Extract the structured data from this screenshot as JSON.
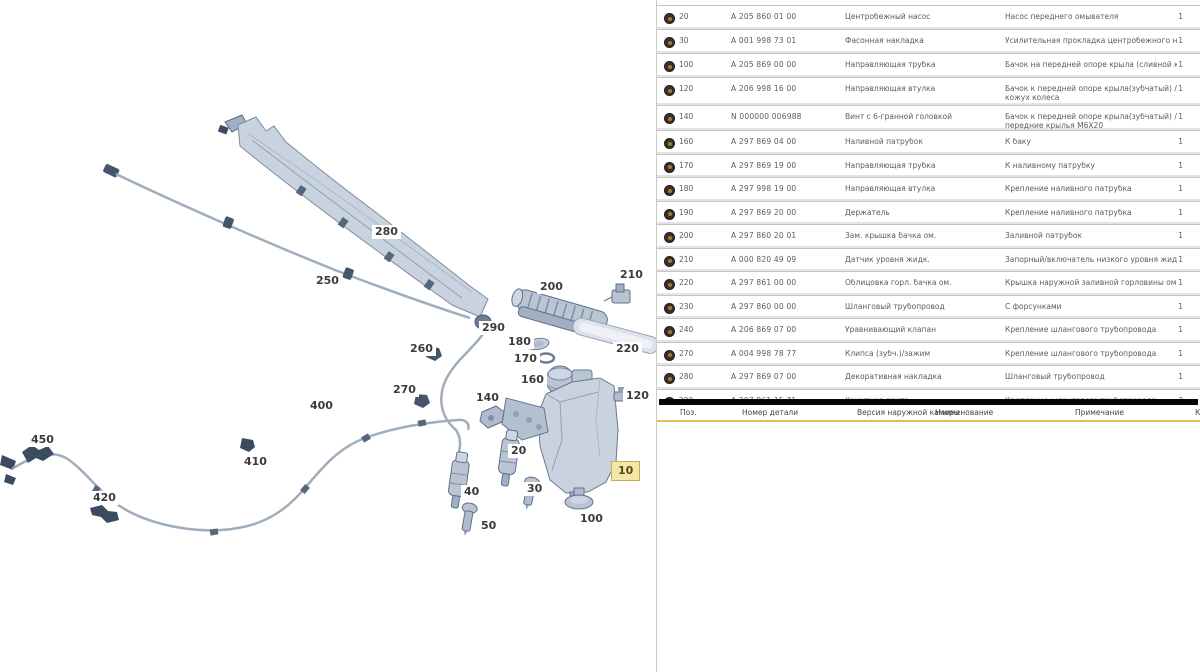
{
  "app": {
    "description": "parts-catalog-washer-system",
    "colors": {
      "highlight_bg": "#f3e7ab",
      "highlight_border": "#c9ac4e",
      "accent_line": "#ddc050",
      "split_bar": "#060606",
      "part_fill": "#c9d3df",
      "part_stroke": "#6e7f95"
    }
  },
  "diagram": {
    "callouts": [
      {
        "n": "280",
        "x": 372,
        "y": 225,
        "highlight": false
      },
      {
        "n": "250",
        "x": 313,
        "y": 274,
        "highlight": false
      },
      {
        "n": "290",
        "x": 479,
        "y": 321,
        "highlight": false
      },
      {
        "n": "260",
        "x": 407,
        "y": 342,
        "highlight": false
      },
      {
        "n": "270",
        "x": 390,
        "y": 383,
        "highlight": false
      },
      {
        "n": "400",
        "x": 307,
        "y": 399,
        "highlight": false
      },
      {
        "n": "450",
        "x": 28,
        "y": 433,
        "highlight": false
      },
      {
        "n": "410",
        "x": 241,
        "y": 455,
        "highlight": false
      },
      {
        "n": "420",
        "x": 90,
        "y": 491,
        "highlight": false
      },
      {
        "n": "200",
        "x": 537,
        "y": 280,
        "highlight": false
      },
      {
        "n": "210",
        "x": 617,
        "y": 268,
        "highlight": false
      },
      {
        "n": "220",
        "x": 613,
        "y": 342,
        "highlight": false
      },
      {
        "n": "180",
        "x": 505,
        "y": 335,
        "highlight": false
      },
      {
        "n": "170",
        "x": 511,
        "y": 352,
        "highlight": false
      },
      {
        "n": "160",
        "x": 518,
        "y": 373,
        "highlight": false
      },
      {
        "n": "140",
        "x": 473,
        "y": 391,
        "highlight": false
      },
      {
        "n": "120",
        "x": 623,
        "y": 389,
        "highlight": false
      },
      {
        "n": "20",
        "x": 508,
        "y": 444,
        "highlight": false
      },
      {
        "n": "30",
        "x": 524,
        "y": 482,
        "highlight": false
      },
      {
        "n": "40",
        "x": 461,
        "y": 485,
        "highlight": false
      },
      {
        "n": "50",
        "x": 478,
        "y": 519,
        "highlight": false
      },
      {
        "n": "100",
        "x": 577,
        "y": 512,
        "highlight": false
      },
      {
        "n": "10",
        "x": 611,
        "y": 461,
        "highlight": true
      }
    ]
  },
  "parts_table": {
    "rows": [
      {
        "pos": "20",
        "num": "A 205 860 01 00",
        "name": "Центробежный насос",
        "remark": "Насос переднего омывателя",
        "qty": "1",
        "wrap": false
      },
      {
        "pos": "30",
        "num": "A 001 998 73 01",
        "name": "Фасонная накладка",
        "remark": "Усилительная прокладка центробежного насоса",
        "qty": "1",
        "wrap": false
      },
      {
        "pos": "100",
        "num": "A 205 869 00 00",
        "name": "Направляющая трубка",
        "remark": "Бачок на передней опоре крыла (сливной кран)",
        "qty": "1",
        "wrap": false
      },
      {
        "pos": "120",
        "num": "A 206 998 16 00",
        "name": "Направляющая втулка",
        "remark": "Бачок к передней опоре крыла(зубчатый) / кожух колеса",
        "qty": "1",
        "wrap": true
      },
      {
        "pos": "140",
        "num": "N 000000 006988",
        "name": "Винт с 6-гранной головкой",
        "remark": "Бачок к передней опоре крыла(зубчатый) / передние крылья M6X20",
        "qty": "1",
        "wrap": true
      },
      {
        "pos": "160",
        "num": "A 297 869 04 00",
        "name": "Наливной патрубок",
        "remark": "К баку",
        "qty": "1",
        "wrap": false
      },
      {
        "pos": "170",
        "num": "A 297 869 19 00",
        "name": "Направляющая трубка",
        "remark": "К наливному патрубку",
        "qty": "1",
        "wrap": false
      },
      {
        "pos": "180",
        "num": "A 297 998 19 00",
        "name": "Направляющая втулка",
        "remark": "Крепление наливного патрубка",
        "qty": "1",
        "wrap": false
      },
      {
        "pos": "190",
        "num": "A 297 869 20 00",
        "name": "Держатель",
        "remark": "Крепление наливного патрубка",
        "qty": "1",
        "wrap": false
      },
      {
        "pos": "200",
        "num": "A 297 860 20 01",
        "name": "Зам. крышка бачка ом.",
        "remark": "Заливной патрубок",
        "qty": "1",
        "wrap": false
      },
      {
        "pos": "210",
        "num": "A 000 820 49 09",
        "name": "Датчик уровня жидк.",
        "remark": "Запорный/включатель низкого уровня жидкости",
        "qty": "1",
        "wrap": false
      },
      {
        "pos": "220",
        "num": "A 297 861 00 00",
        "name": "Облицовка горл. бачка ом.",
        "remark": "Крышка наружной заливной горловины омывающей жидкости",
        "qty": "1",
        "wrap": false
      },
      {
        "pos": "230",
        "num": "A 297 860 00 00",
        "name": "Шланговый трубопровод",
        "remark": "С форсунками",
        "qty": "1",
        "wrap": false
      },
      {
        "pos": "240",
        "num": "A 206 869 07 00",
        "name": "Уравнивающий клапан",
        "remark": "Крепление шлангового трубопровода",
        "qty": "1",
        "wrap": false
      },
      {
        "pos": "270",
        "num": "A 004 998 78 77",
        "name": "Клипса (зубч.)/зажим",
        "remark": "Крепление шлангового трубопровода",
        "qty": "1",
        "wrap": false
      },
      {
        "pos": "280",
        "num": "A 297 869 07 00",
        "name": "Декоративная накладка",
        "remark": "Шланговый трубопровод",
        "qty": "1",
        "wrap": false
      },
      {
        "pos": "290",
        "num": "A 297 861 15 71",
        "name": "Хомутная лента",
        "remark": "Крепление шлангового трубопровода",
        "qty": "2",
        "wrap": false
      }
    ]
  },
  "second_table_header": {
    "columns": [
      "Поз.",
      "Номер детали",
      "Версия наружной камеры",
      "Наименование",
      "Примечание",
      "Кол."
    ]
  }
}
